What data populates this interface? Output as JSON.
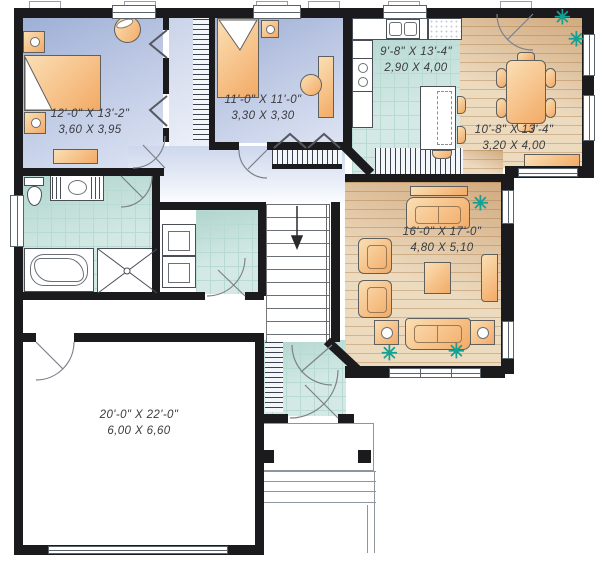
{
  "plan_title": "Single-storey house floor plan",
  "rooms": {
    "master": {
      "name": "master-bedroom",
      "imperial": "12'-0\" X 13'-2\"",
      "metric": "3,60 X 3,95"
    },
    "bedroom2": {
      "name": "bedroom-2",
      "imperial": "11'-0\" X 11'-0\"",
      "metric": "3,30 X 3,30"
    },
    "kitchen": {
      "name": "kitchen",
      "imperial": "9'-8\" X 13'-4\"",
      "metric": "2,90 X 4,00"
    },
    "dining": {
      "name": "dining-room",
      "imperial": "10'-8\" X 13'-4\"",
      "metric": "3,20 X 4,00"
    },
    "living": {
      "name": "living-room",
      "imperial": "16'-0\" X 17'-0\"",
      "metric": "4,80 X 5,10"
    },
    "garage": {
      "name": "garage",
      "imperial": "20'-0\" X 22'-0\"",
      "metric": "6,00 X 6,60"
    }
  },
  "icons": {
    "plant": "✳"
  },
  "colors": {
    "wall": "#1b1b1d",
    "bedroom_floor": "#b9c5e2",
    "tile_floor": "#cfe7e2",
    "wood_floor": "#ecd9bd",
    "furniture": "#f3aa66",
    "plant": "#12a192",
    "label_text": "#3b3b40"
  }
}
